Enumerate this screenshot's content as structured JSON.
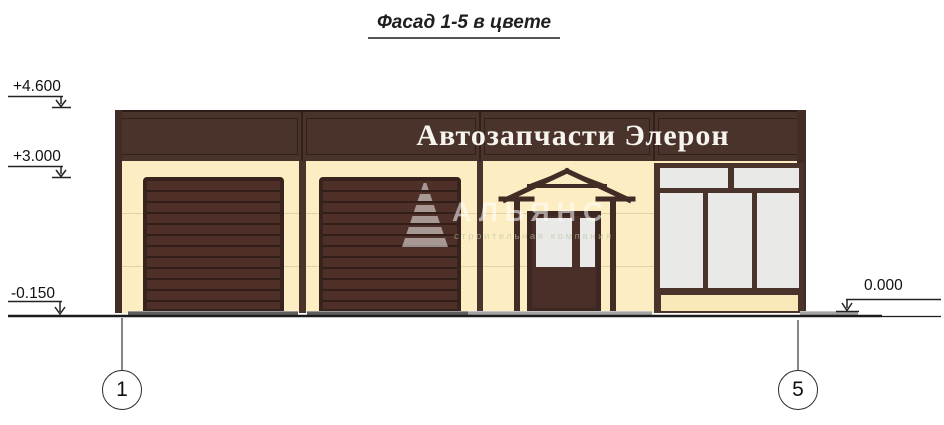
{
  "drawing": {
    "title": "Фасад 1-5 в цвете",
    "sign": "Автозапчасти Элерон",
    "elevations": {
      "plus4600": "+4.600",
      "plus3000": "+3.000",
      "minus0150": "-0.150",
      "zero": "0.000"
    },
    "axes": {
      "left_bubble": "1",
      "right_bubble": "5"
    },
    "watermark": {
      "name": "АЛЬЯНС",
      "subtitle": "строительная компания"
    },
    "colors": {
      "facade-brown": "#4a332b",
      "frame-dark": "#39231e",
      "wall-cream": "#fdedc2",
      "spandrel-cream": "#fbe8b8",
      "glass": "#e9e9e7",
      "apron-dark": "#5f5f5f",
      "apron-light": "#a3a3a3",
      "line-black": "#1c1c1c"
    }
  }
}
